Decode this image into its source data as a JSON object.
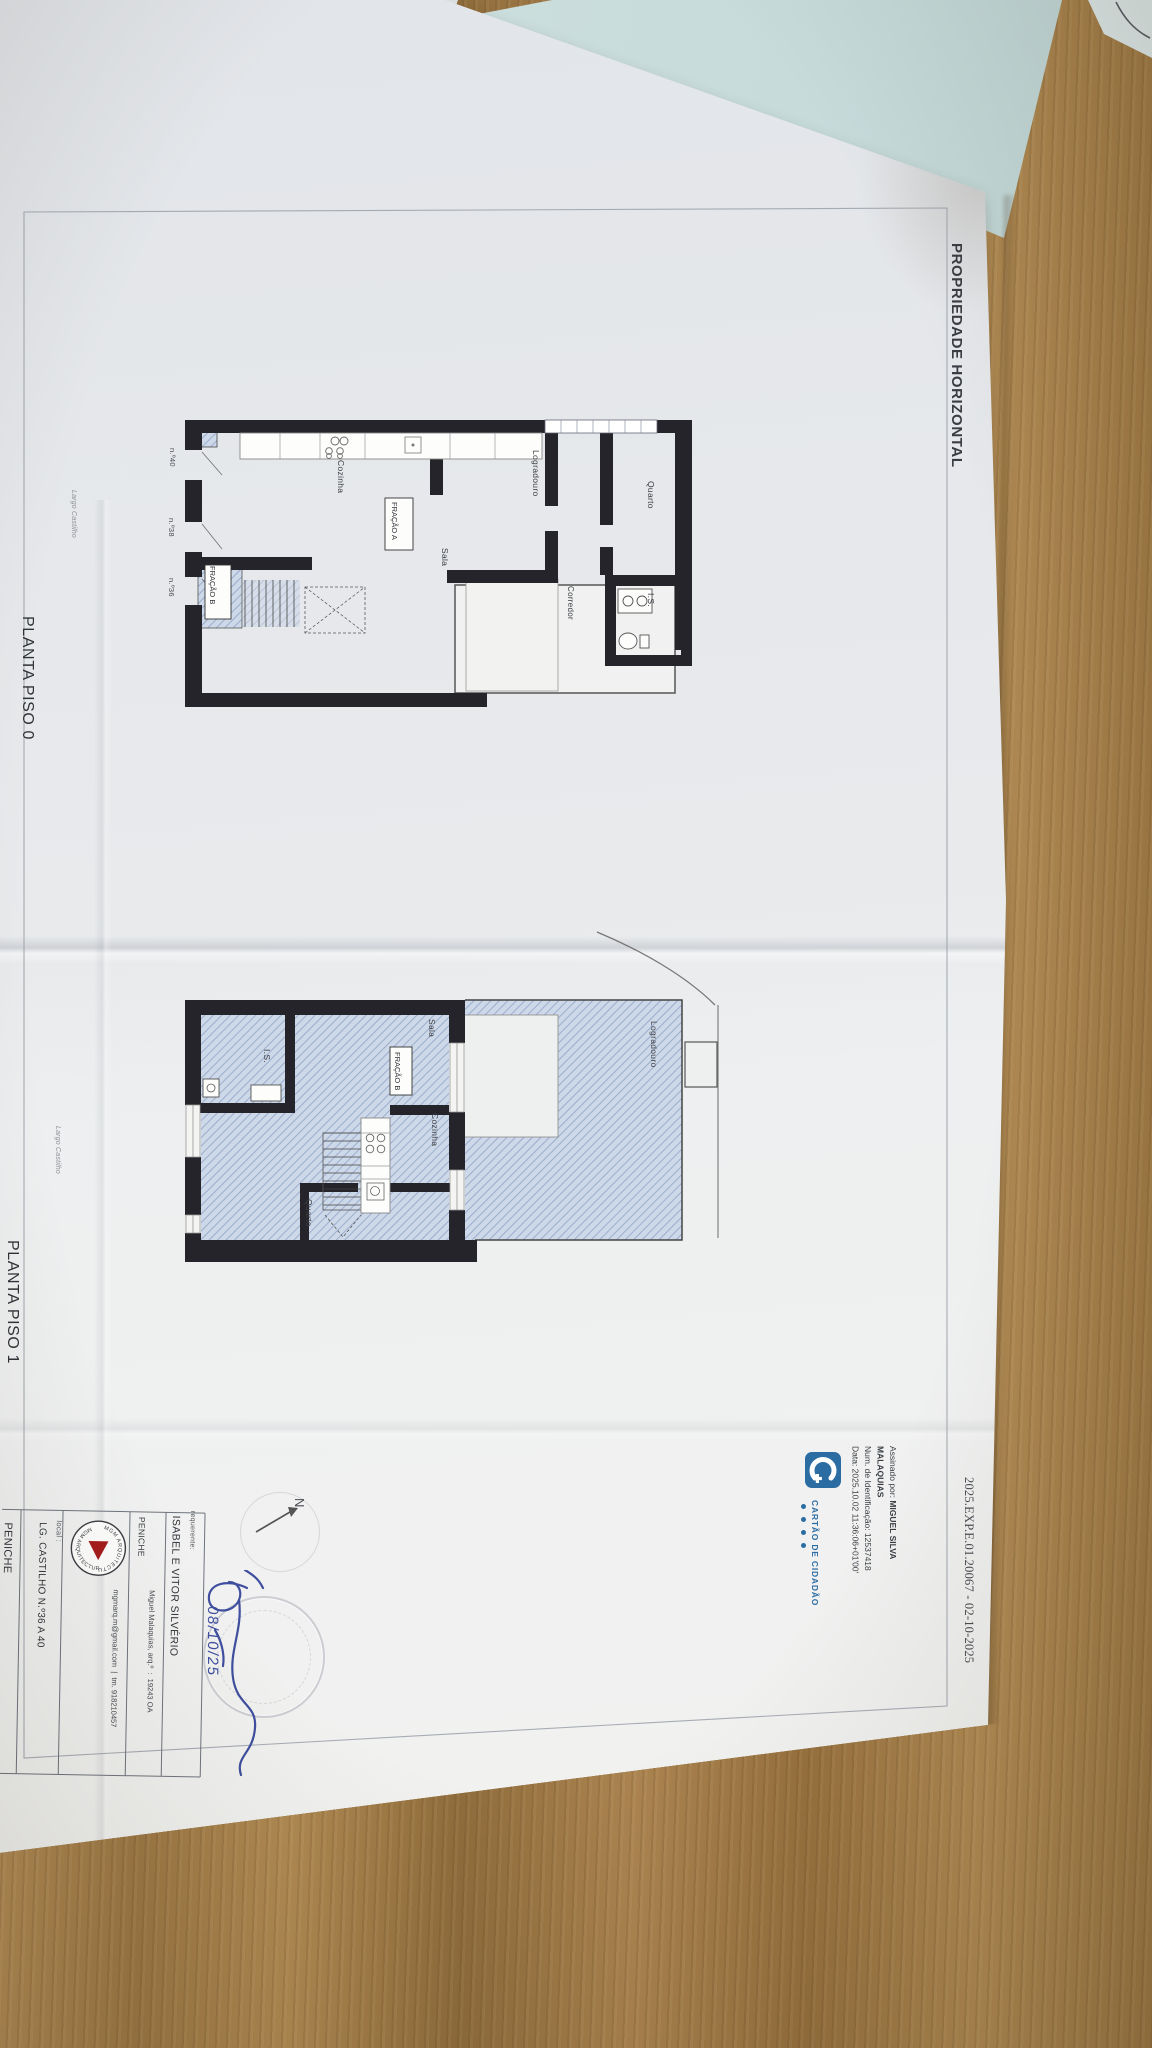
{
  "document": {
    "header_title": "PROPRIEDADE HORIZONTAL",
    "reference": "2025.EXP.E.01.20067 - 02-10-2025"
  },
  "plans": {
    "piso0": {
      "title": "PLANTA PISO 0",
      "street": "Largo Castilho",
      "rooms": {
        "quarto": "Quarto",
        "is": "I.S.",
        "corredor": "Corredor",
        "logradouro": "Logradouro",
        "sala": "Sala",
        "cozinha": "Cozinha"
      },
      "fractions": {
        "a": "FRAÇÃO A",
        "b": "FRAÇÃO B"
      },
      "doors": {
        "n40": "n.º40",
        "n38": "n.º38",
        "n36": "n.º36"
      }
    },
    "piso1": {
      "title": "PLANTA PISO 1",
      "street": "Largo Castilho",
      "rooms": {
        "logradouro": "Logradouro",
        "sala": "Sala",
        "cozinha": "Cozinha",
        "is": "I.S.",
        "quarto": "Quarto"
      },
      "fractions": {
        "b": "FRAÇÃO B"
      }
    }
  },
  "signature": {
    "signed_by_label": "Assinado por: ",
    "name_line1": "MIGUEL SILVA",
    "name_line2": "MALAQUIAS",
    "id_line": "Num. de Identificação: 12537418",
    "date_line": "Data: 2025.10.02 11:36:06+01'00'",
    "brand": "CARTÃO DE CIDADÃO"
  },
  "title_block": {
    "requerente_label": "requerente:",
    "requerente": "ISABEL E VITOR SILVÉRIO",
    "municipality": "PENICHE",
    "architect": "Miguel Malaquias, arq.º  :  19243 OA",
    "contact": "mgmarq.m@gmail.com  |  tm. 918210457",
    "logo_text": "MGM ARQUITECTURA",
    "local_label": "local :",
    "local": "LG. CASTILHO N.º36 A 40",
    "municipality2": "PENICHE"
  },
  "annotations": {
    "north": "N",
    "handwritten_date": "08/10/25"
  },
  "colors": {
    "cc_blue": "#2b6ca3",
    "ink_blue": "#3f4e9e",
    "hatch_blue": "#c9d4e6"
  }
}
